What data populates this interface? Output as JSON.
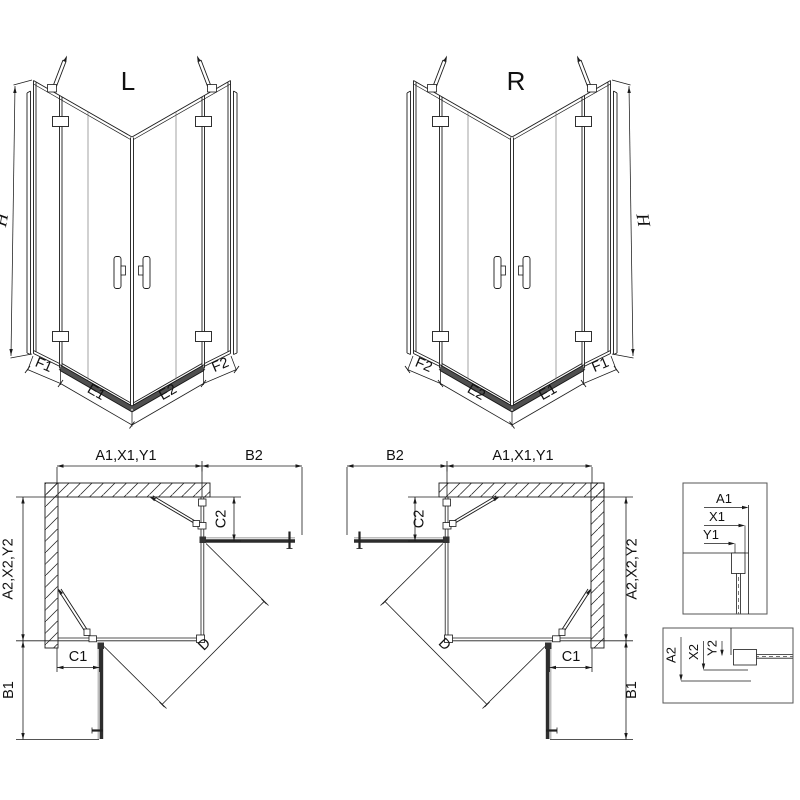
{
  "drawing": {
    "perspective_left": {
      "label": "L",
      "height": "H",
      "segments": [
        "F1",
        "E1",
        "E2",
        "F2"
      ]
    },
    "perspective_right": {
      "label": "R",
      "height": "H",
      "segments": [
        "F2",
        "E2",
        "E1",
        "F1"
      ]
    },
    "plan_left": {
      "width_top": "A1,X1,Y1",
      "door_side": "B2",
      "fixed_side": "C2",
      "depth": "A2,X2,Y2",
      "fixed_bottom": "C1",
      "door_bottom": "B1",
      "diagonal": "D"
    },
    "plan_right": {
      "door_side": "B2",
      "width_top": "A1,X1,Y1",
      "fixed_side": "C2",
      "depth": "A2,X2,Y2",
      "fixed_bottom": "C1",
      "door_bottom": "B1",
      "diagonal": "D"
    },
    "detail_wall": {
      "a": "A1",
      "x": "X1",
      "y": "Y1"
    },
    "detail_floor": {
      "a": "A2",
      "x": "X2",
      "y": "Y2"
    },
    "colors": {
      "line": "#1a1a1a",
      "door_dark": "#2d2d2d",
      "door_light": "#a8a8a8",
      "threshold": "#4f4f4f",
      "background": "#ffffff"
    }
  }
}
